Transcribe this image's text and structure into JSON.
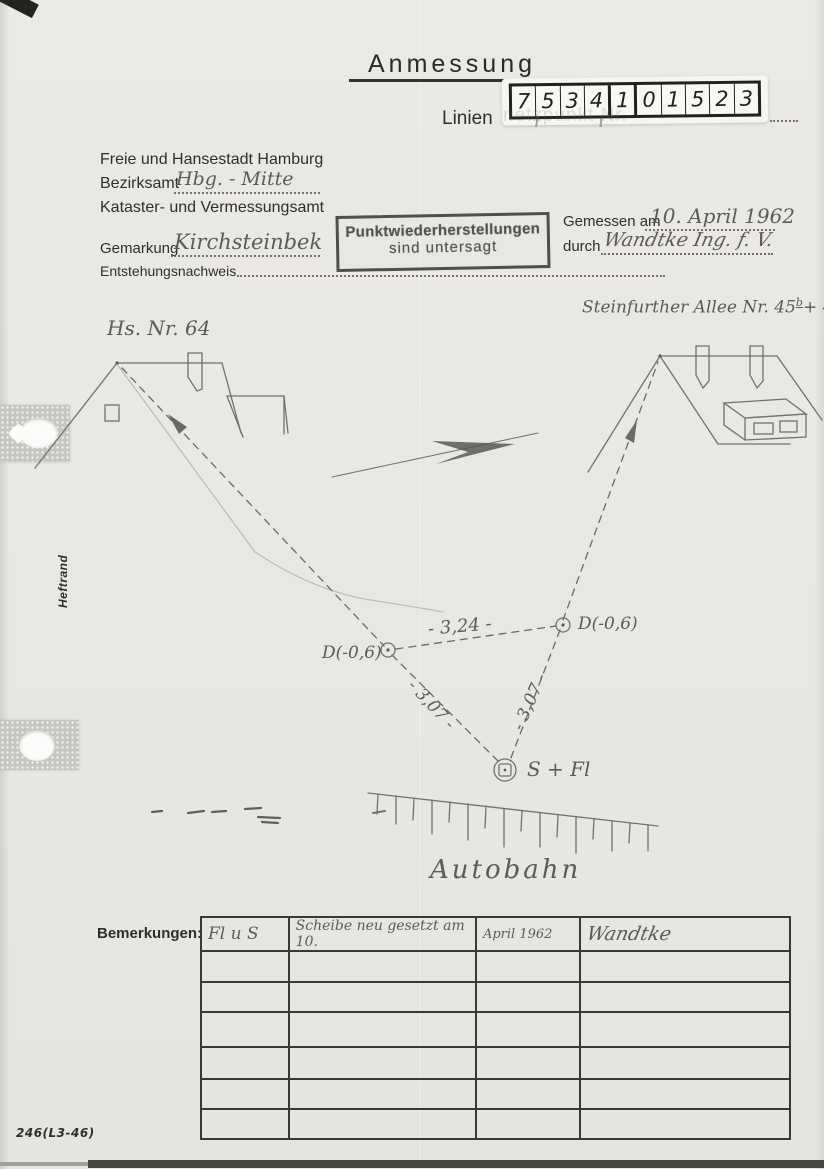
{
  "colors": {
    "paper": "#e8e7e3",
    "print": "#2f2e2a",
    "pencil": "#73716c",
    "stamp": "#514f4b"
  },
  "title": {
    "heading": "Anmessung",
    "line_prefix": "Linien",
    "line_ghost": "netzpunkt  Nr.",
    "digits": [
      "7",
      "5",
      "3",
      "4",
      "1",
      "0",
      "1",
      "5",
      "2",
      "3"
    ]
  },
  "header": {
    "authority": "Freie und Hansestadt Hamburg",
    "district_label": "Bezirksamt",
    "district_value": "Hbg. - Mitte",
    "office": "Kataster- und Vermessungsamt",
    "gemarkung_label": "Gemarkung",
    "gemarkung_value": "Kirchsteinbek",
    "provenance_label": "Entstehungsnachweis",
    "stamp_line1": "Punktwiederherstellungen",
    "stamp_line2": "sind untersagt",
    "measured_label": "Gemessen am",
    "measured_value": "10. April 1962",
    "by_label": "durch",
    "by_value": "Wandtke  Ing. f. V."
  },
  "sketch": {
    "left_house_label": "Hs. Nr. 64",
    "right_house_label": "Steinfurther Allee  Nr. 45",
    "right_house_sup_b": "b",
    "right_house_mid": "+ 45",
    "right_house_sup_c": "c",
    "point_left_label": "D(-0,6)",
    "point_right_label": "D(-0,6)",
    "dist_top": "- 3,24 -",
    "dist_left": "- 3,07 -",
    "dist_right": "- 3,07 -",
    "marker_label": "S + Fl",
    "road_label": "Autobahn"
  },
  "remarks": {
    "label": "Bemerkungen:",
    "rows": [
      [
        "Fl u S",
        "Scheibe neu gesetzt  am 10.",
        "April 1962",
        "Wandtke"
      ],
      [
        "",
        "",
        "",
        ""
      ],
      [
        "",
        "",
        "",
        ""
      ],
      [
        "",
        "",
        "",
        ""
      ],
      [
        "",
        "",
        "",
        ""
      ],
      [
        "",
        "",
        "",
        ""
      ],
      [
        "",
        "",
        "",
        ""
      ]
    ]
  },
  "footer": {
    "form_number": "246(L3-46)",
    "margin_label": "Heftrand"
  }
}
